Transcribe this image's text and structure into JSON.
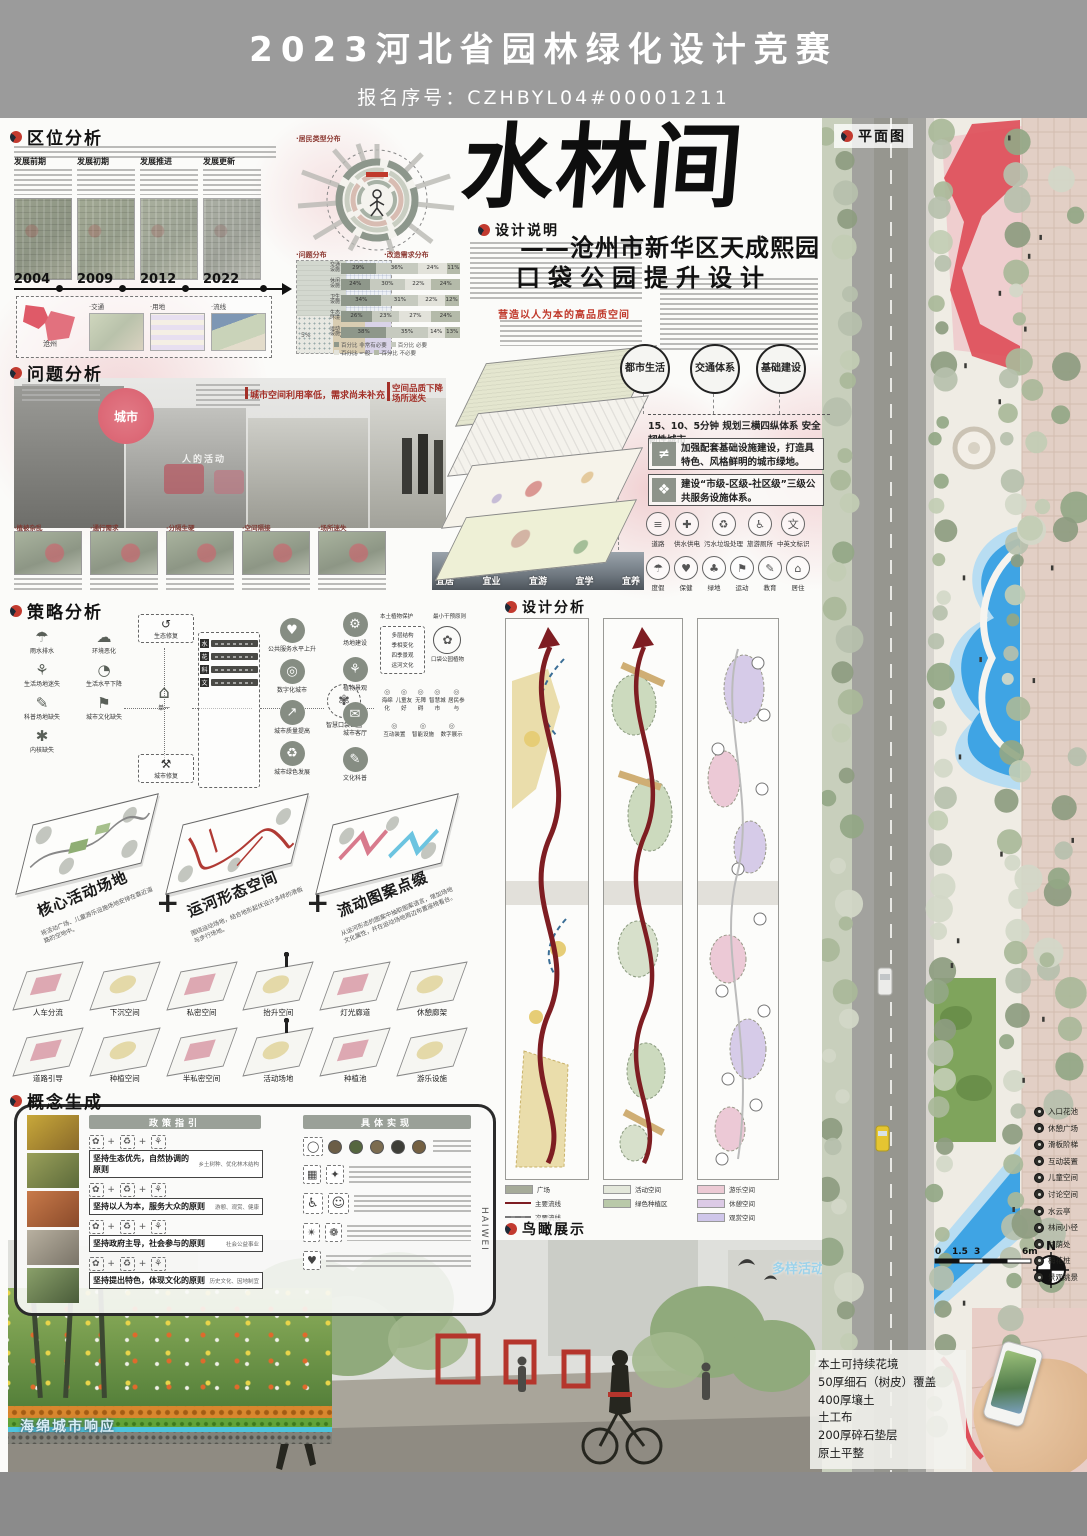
{
  "header": {
    "title": "2023河北省园林绿化设计竞赛",
    "reg_no": "报名序号：CZHBYL04#00001211"
  },
  "section_titles": {
    "quwei": "区位分析",
    "wenti": "问题分析",
    "celue": "策略分析",
    "gainian": "概念生成",
    "shuoming": "设计说明",
    "fenxi": "设计分析",
    "niaokan": "鸟瞰展示",
    "pingmian": "平面图"
  },
  "quwei": {
    "phases": [
      "发展前期",
      "发展初期",
      "发展推进",
      "发展更新"
    ],
    "years": [
      "2004",
      "2009",
      "2012",
      "2022"
    ],
    "city_label": "沧州",
    "sub_labels": [
      "·交通",
      "·用地",
      "·流线"
    ]
  },
  "charts": {
    "resident_title": "·居民类型分布",
    "problem_title": "·问题分布",
    "demand_title": "·改造需求分布",
    "problem_tags": [
      "5%",
      "7%",
      "7%"
    ]
  },
  "chart_data": {
    "type": "bar",
    "stacked": true,
    "orientation": "horizontal",
    "title": "改造需求分布",
    "categories": [
      "交通设施",
      "休闲设施",
      "卫生设施",
      "生态环境",
      "运动设施"
    ],
    "series": [
      {
        "name": "非常有必要",
        "values": [
          29,
          24,
          34,
          26,
          38
        ]
      },
      {
        "name": "必要",
        "values": [
          36,
          30,
          31,
          23,
          35
        ]
      },
      {
        "name": "一般",
        "values": [
          24,
          22,
          22,
          27,
          14
        ]
      },
      {
        "name": "不必要",
        "values": [
          11,
          24,
          12,
          24,
          13
        ]
      }
    ],
    "unit": "%",
    "colors": [
      "#8e978a",
      "#c6cabf",
      "#e2e2da",
      "#b4baa9"
    ],
    "legend": [
      "百分比 非常有必要",
      "百分比 必要",
      "百分比 一般",
      "百分比 不必要"
    ],
    "xlim": [
      0,
      100
    ]
  },
  "wenti": {
    "city_bubble": "城市",
    "people_label": "人的活动",
    "ann1": "城市空间利用率低，需求尚未补充",
    "ann2": "空间品质下降",
    "ann2b": "场所迷失",
    "photo_tags": [
      "·植被杂乱",
      "·通行需求",
      "·分隔生硬",
      "·空间隔接",
      "·场所迷失"
    ],
    "suit_labels": [
      "宜居",
      "宜业",
      "宜游",
      "宜学",
      "宜养"
    ]
  },
  "celue": {
    "left_items": [
      {
        "g": "☂",
        "label": "雨水排水"
      },
      {
        "g": "☁",
        "label": "环境恶化"
      },
      {
        "g": "⚘",
        "label": "生活场地迷失"
      },
      {
        "g": "◔",
        "label": "生活水平下降"
      },
      {
        "g": "✎",
        "label": "科普场地缺失"
      },
      {
        "g": "⚑",
        "label": "城市文化缺失"
      },
      {
        "g": "✱",
        "label": "内核缺失"
      }
    ],
    "eco_label": "生态修复",
    "city_fix_label": "城市修复",
    "single_label": "单一",
    "chips": [
      "水",
      "花",
      "科",
      "文"
    ],
    "outcomes": [
      {
        "g": "♥",
        "label": "公共服务水平上升"
      },
      {
        "g": "◎",
        "label": "数字化城市"
      },
      {
        "g": "↗",
        "label": "城市质量提高"
      },
      {
        "g": "♻",
        "label": "城市绿色发展"
      }
    ],
    "smart_label": "智慧口袋公园",
    "categories": [
      {
        "g": "⚙",
        "label": "场地建设"
      },
      {
        "g": "⚘",
        "label": "植物景观"
      },
      {
        "g": "✉",
        "label": "城市客厅"
      },
      {
        "g": "✎",
        "label": "文化科普"
      }
    ],
    "site_items": [
      "本土植物保护",
      "最小干预原则"
    ],
    "plant_items": [
      "多层结构",
      "季相变化",
      "四季景观",
      "运河文化"
    ],
    "plant_result": "口袋公园植物",
    "hall_items": [
      "海绵化",
      "儿童友好",
      "无障碍",
      "智慧城市",
      "居民参与"
    ],
    "culture_items": [
      "互动装置",
      "智能设施",
      "数字展示"
    ]
  },
  "axon": {
    "plus": "+",
    "cards": [
      {
        "title": "核心活动场地",
        "desc": "将活动广场、儿童游乐设施场地安排在靠近道路的空地中。"
      },
      {
        "title": "运河形态空间",
        "desc": "围绕运动场地，结合地形起伏设计多样的滑板与步行场地。"
      },
      {
        "title": "流动图案点缀",
        "desc": "从运河形态的图案中抽取图案语言，增加场地文化属性，并在运动场地周边布置座椅看台。"
      }
    ]
  },
  "tiles": {
    "row1": [
      "人车分流",
      "下沉空间",
      "私密空间",
      "抬升空间",
      "灯光廊道",
      "休憩廊架"
    ],
    "row2": [
      "道路引导",
      "种植空间",
      "半私密空间",
      "活动场地",
      "种植池",
      "游乐设施"
    ]
  },
  "gainian": {
    "left_header": "政策指引",
    "right_header": "具体实现",
    "principles": [
      {
        "text": "坚持生态优先，自然协调的原则",
        "note": "乡土树种、优化林木结构"
      },
      {
        "text": "坚持以人为本，服务大众的原则",
        "note": "游憩、观赏、健康"
      },
      {
        "text": "坚持政府主导，社会参与的原则",
        "note": "社会公益事业"
      },
      {
        "text": "坚持提出特色，体现文化的原则",
        "note": "历史文化、因地制宜"
      }
    ],
    "brand": "HAIWEI"
  },
  "shuoming": {
    "highlight": "营造以人为本的高品质空间"
  },
  "trio": {
    "circles": [
      "都市生活",
      "交通体系",
      "基础建设"
    ],
    "minutes_line": "15、10、5分钟  规划三横四纵体系 安全韧性城市",
    "box1": "加强配套基础设施建设，打造具特色、风格鲜明的城市绿地。",
    "box2": "建设“市级-区级-社区级”三级公共服务设施体系。",
    "facility_row": [
      {
        "g": "≡",
        "label": "道路"
      },
      {
        "g": "✚",
        "label": "供水供电"
      },
      {
        "g": "♻",
        "label": "污水垃圾处理"
      },
      {
        "g": "♿",
        "label": "旅游厕所"
      },
      {
        "g": "文",
        "label": "中英文标识"
      }
    ],
    "service_row": [
      {
        "g": "☂",
        "label": "度假"
      },
      {
        "g": "♥",
        "label": "保健"
      },
      {
        "g": "♣",
        "label": "绿地"
      },
      {
        "g": "⚑",
        "label": "运动"
      },
      {
        "g": "✎",
        "label": "教育"
      },
      {
        "g": "⌂",
        "label": "居住"
      }
    ]
  },
  "fenxi_legend": {
    "g1": [
      {
        "label": "广场",
        "type": "swatch",
        "color": "#a6ab99"
      },
      {
        "label": "主要流线",
        "type": "line",
        "color": "#7e1d22"
      },
      {
        "label": "次要流线",
        "type": "dash",
        "color": "#8a8a8a"
      }
    ],
    "g2": [
      {
        "label": "活动空间",
        "type": "swatch",
        "color": "#e3e7da"
      },
      {
        "label": "绿色种植区",
        "type": "swatch",
        "color": "#b9c9a9"
      }
    ],
    "g3": [
      {
        "label": "游乐空间",
        "type": "swatch",
        "color": "#eccad4"
      },
      {
        "label": "休憩空间",
        "type": "swatch",
        "color": "#dccae6"
      },
      {
        "label": "观赏空间",
        "type": "swatch",
        "color": "#cfc6ea"
      }
    ]
  },
  "niaokan": {
    "annotation": "多样活动空间",
    "sponge_label": "海绵城市响应"
  },
  "plan": {
    "legend": [
      "入口花池",
      "休憩广场",
      "滑板阶梯",
      "互动装置",
      "儿童空间",
      "讨论空间",
      "水云亭",
      "林间小径",
      "林荫处",
      "梅花桩",
      "景观眺景"
    ],
    "scale_ticks": [
      "0",
      "1.5",
      "3",
      "6m"
    ],
    "north": "N",
    "construction": [
      "本土可持续花境",
      "50厚细石（树皮）覆盖",
      "400厚壤土",
      "土工布",
      "200厚碎石垫层",
      "原土平整"
    ]
  }
}
